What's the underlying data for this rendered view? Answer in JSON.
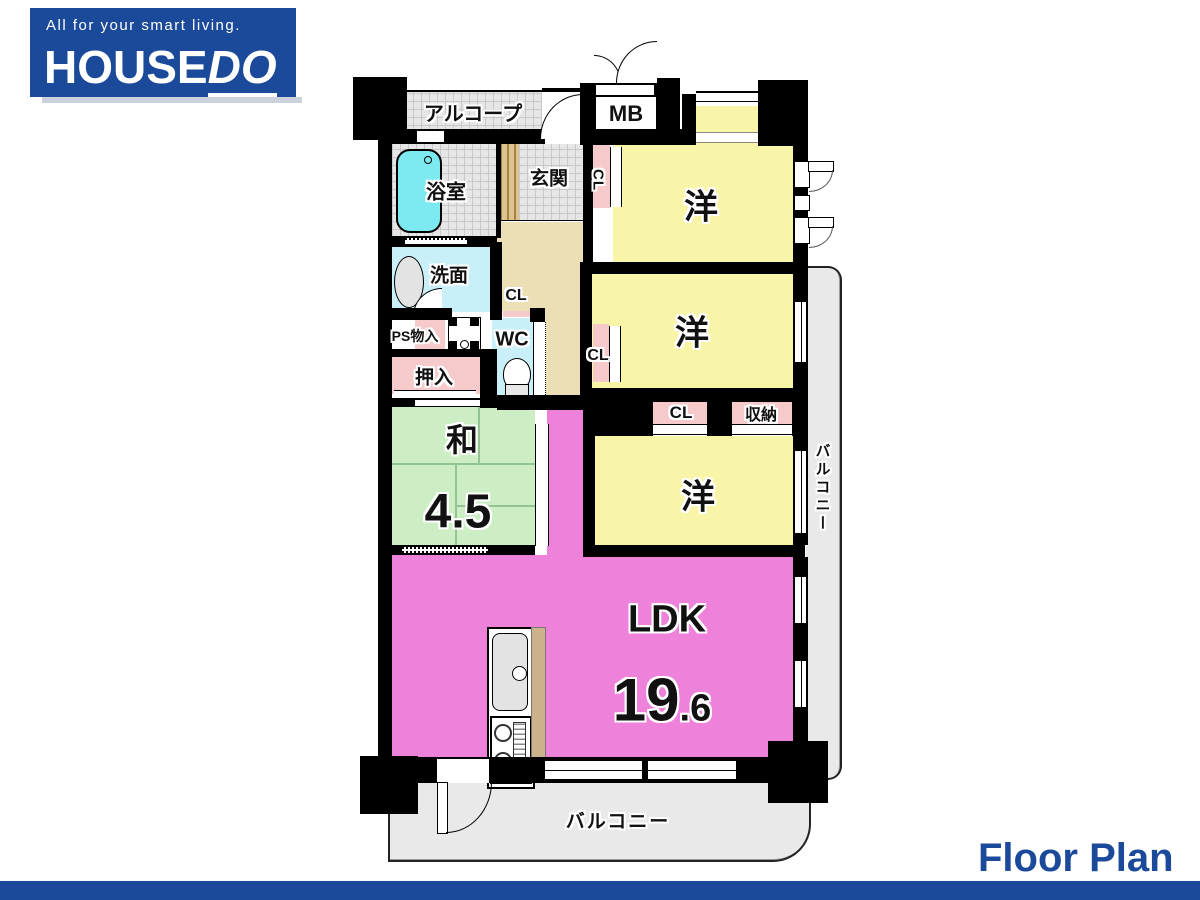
{
  "header": {
    "tagline": "All for your smart living.",
    "brand_main": "HOUSE",
    "brand_accent": "DO"
  },
  "footer": {
    "title": "Floor Plan"
  },
  "rooms": {
    "alcove": "アルコープ",
    "meter_box": "MB",
    "bathroom": "浴室",
    "entrance": "玄関",
    "washroom": "洗面",
    "toilet": "WC",
    "ps_storage": "PS物入",
    "futon_closet": "押入",
    "japanese_room": {
      "label": "和",
      "size": "4.5"
    },
    "western_room_1": "洋",
    "western_room_2": "洋",
    "western_room_3": "洋",
    "ldk": {
      "label": "LDK",
      "size_int": "19",
      "size_dec": ".6"
    }
  },
  "closets": {
    "hall_closet": "CL",
    "closet_room1": "CL",
    "closet_room2": "CL",
    "closet_room3": "CL",
    "storage": "収納"
  },
  "balconies": {
    "right": "バルコニー",
    "bottom": "バルコニー"
  },
  "colors": {
    "brand_blue": "#1b4a9a",
    "wall_black": "#000000",
    "room_yellow": "#f9f5a8",
    "room_green": "#cdeec4",
    "ldk_pink": "#ee82da",
    "closet_pink": "#f6caca",
    "water_cyan": "#c9f0f8",
    "tub_cyan": "#7de9f0",
    "hallway_beige": "#ecdfb5",
    "balcony_grey": "#e9e9e9"
  }
}
